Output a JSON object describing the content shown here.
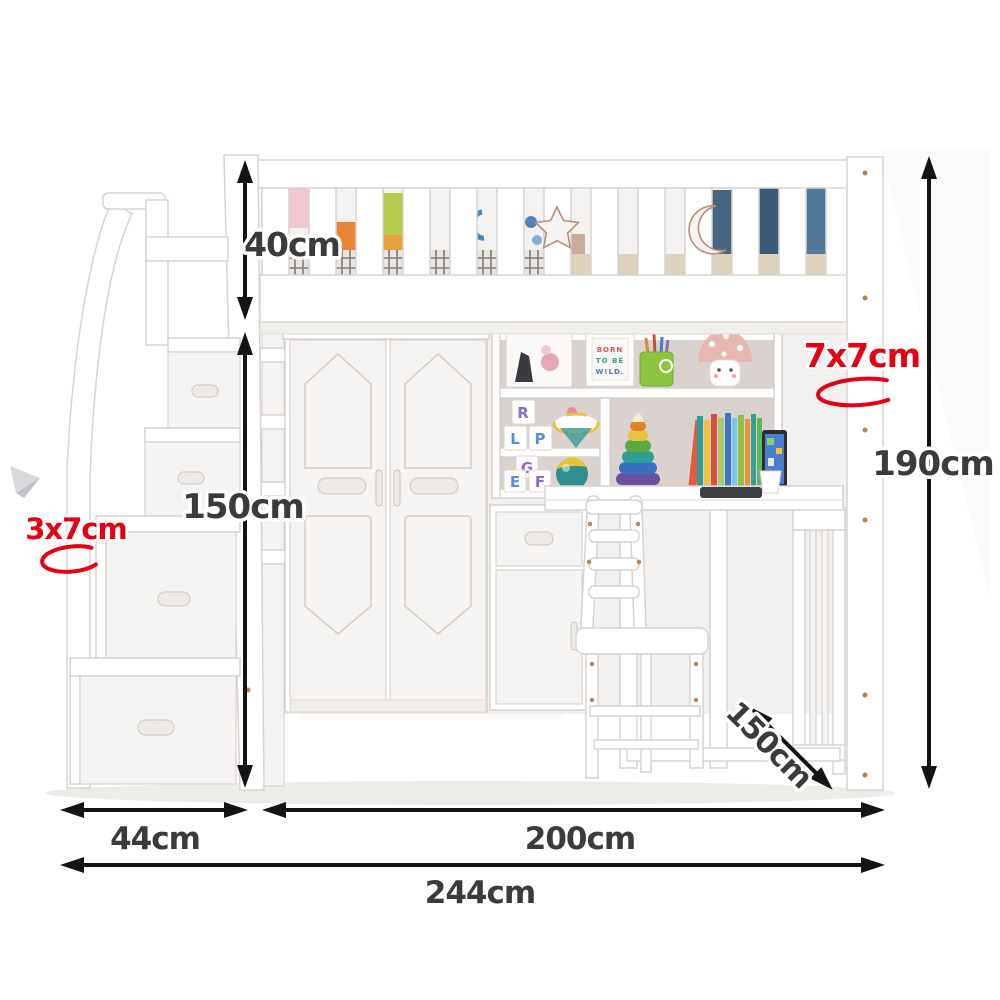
{
  "diagram": {
    "type": "furniture-dimension-diagram",
    "subject": "white loft bed with storage staircase, wardrobe, shelving and corner desk"
  },
  "dimensions": {
    "rail_height": {
      "label": "40cm"
    },
    "clearance_height": {
      "label": "150cm"
    },
    "total_height": {
      "label": "190cm"
    },
    "stair_width": {
      "label": "44cm"
    },
    "bed_length": {
      "label": "200cm"
    },
    "total_width": {
      "label": "244cm"
    },
    "depth": {
      "label": "150cm"
    },
    "stair_rail_post": {
      "label": "3x7cm"
    },
    "bed_post": {
      "label": "7x7cm"
    }
  },
  "decor": {
    "frame_lines": [
      "BORN",
      "TO BE",
      "W!LD."
    ],
    "letter_blocks_upper": [
      "R",
      "L",
      "P"
    ],
    "letter_blocks_lower": [
      "G",
      "E",
      "F"
    ]
  },
  "colors": {
    "dimension_text": "#3b3b3b",
    "arrow": "#141414",
    "accent_red": "#e60012",
    "furniture_white": "#ffffff",
    "panel_gray": "#d9d2ce",
    "bedding_blue": "#49637a"
  }
}
